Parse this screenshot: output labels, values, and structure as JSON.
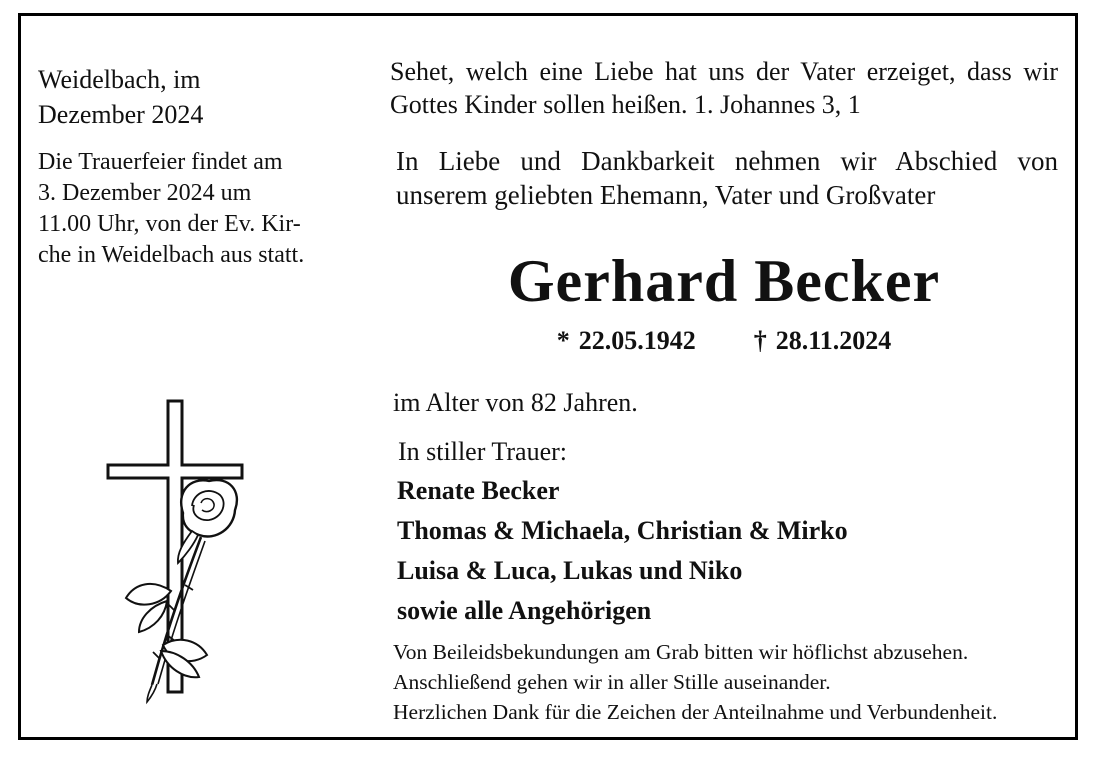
{
  "colors": {
    "ink": "#111111",
    "border": "#000000",
    "background": "#ffffff"
  },
  "left": {
    "dateline_lines": [
      "Weidelbach, im",
      "Dezember 2024"
    ],
    "service_lines": [
      "Die Trauerfeier findet am",
      "3. Dezember 2024 um",
      "11.00 Uhr, von der Ev. Kir-",
      "che in Weidelbach aus statt."
    ],
    "emblem": "cross-with-rose"
  },
  "main": {
    "quote_lines": [
      "Sehet, welch eine Liebe hat uns der Vater erzeiget, dass wir",
      "Gottes Kinder sollen heißen. 1. Johannes 3, 1"
    ],
    "intro_lines": [
      "In Liebe und Dankbarkeit nehmen wir Abschied von",
      "unserem geliebten Ehemann, Vater und Großvater"
    ],
    "name": "Gerhard Becker",
    "birth": {
      "symbol": "*",
      "date": "22.05.1942"
    },
    "death": {
      "symbol": "†",
      "date": "28.11.2024"
    },
    "age_line": "im Alter von 82 Jahren.",
    "mourning_label": "In stiller Trauer:",
    "mourners": [
      "Renate Becker",
      "Thomas & Michaela, Christian & Mirko",
      "Luisa & Luca, Lukas und Niko",
      "sowie alle Angehörigen"
    ],
    "closing_lines": [
      "Von Beileidsbekundungen am Grab bitten wir höflichst abzusehen.",
      "Anschließend gehen wir in aller Stille auseinander.",
      "Herzlichen Dank für die Zeichen der Anteilnahme und Verbundenheit."
    ]
  }
}
